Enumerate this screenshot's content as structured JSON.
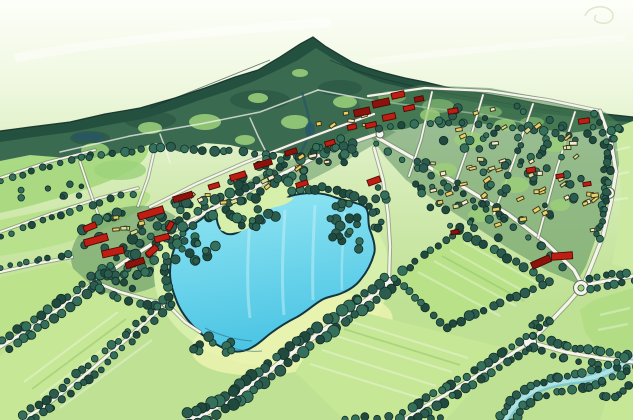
{
  "scene": {
    "name": "watercolor-aerial-masterplan",
    "description": "Hand-drawn watercolor bird's-eye illustration of a lakeside town masterplan with forested ridge, central lake, village clusters, road network and farm fields",
    "style": "watercolor-sketch",
    "colors": {
      "sky_top": "#fdfef9",
      "sky_mid": "#eff8e0",
      "sky_low": "#d6ecb8",
      "base_green": "#bfe193",
      "forest_dark": "#24503f",
      "forest_mid": "#3a6b51",
      "ridge_ink": "#16302a",
      "clearing_green": "#9ed27c",
      "meadow_green": "#a8d87f",
      "meadow_light": "#b7e08b",
      "town_wash": "#4f8758",
      "town_light": "#9ccf78",
      "lake_top": "#93e6f3",
      "lake_bottom": "#4cc5e4",
      "lake_ink": "#133441",
      "lake_streak": "#c3eff6",
      "lake_ripple": "#2f7187",
      "shore_green": "#d6efab",
      "shore_yellow": "#e9f3ae",
      "field_a": "#b9e187",
      "field_b": "#c6e795",
      "field_c": "#b3dd85",
      "field_pale": "#cdeaa2",
      "field_left": "#bce28c",
      "road_white": "#f5f3ec",
      "road_ink": "#5a6b58",
      "tree_dark": "#2b5c4e",
      "tree_mid": "#35705b",
      "tree_deep": "#1f4a3d",
      "tree_ink": "#14302a",
      "roof_red": "#c01d13",
      "roof_dark_red": "#8c130c",
      "roof_ink": "#4a0a06",
      "building_yellow": "#e8d169",
      "building_cream": "#f2ecd2",
      "building_green": "#cfe09a",
      "building_ink": "#3a3318",
      "stream_blue": "#79c7d2",
      "stream_light": "#b5e4e4",
      "water_dark": "#27556b"
    },
    "regions": [
      {
        "name": "forested-ridge",
        "color_key": "forest_dark"
      },
      {
        "name": "hillside-forest",
        "color_key": "forest_mid"
      },
      {
        "name": "central-lake",
        "color_key": "lake_bottom"
      },
      {
        "name": "lake-peninsula",
        "color_key": "shore_green"
      },
      {
        "name": "west-village",
        "color_key": "town_wash"
      },
      {
        "name": "main-street-district",
        "color_key": "town_wash"
      },
      {
        "name": "east-district-grid",
        "color_key": "town_wash"
      },
      {
        "name": "farm-fields",
        "color_key": "field_a"
      },
      {
        "name": "stream-wetland",
        "color_key": "stream_blue"
      },
      {
        "name": "road-network",
        "color_key": "road_white"
      },
      {
        "name": "red-roof-buildings",
        "color_key": "roof_red"
      },
      {
        "name": "yellow-buildings",
        "color_key": "building_yellow"
      },
      {
        "name": "hedgerow-trees",
        "color_key": "tree_dark"
      }
    ]
  }
}
